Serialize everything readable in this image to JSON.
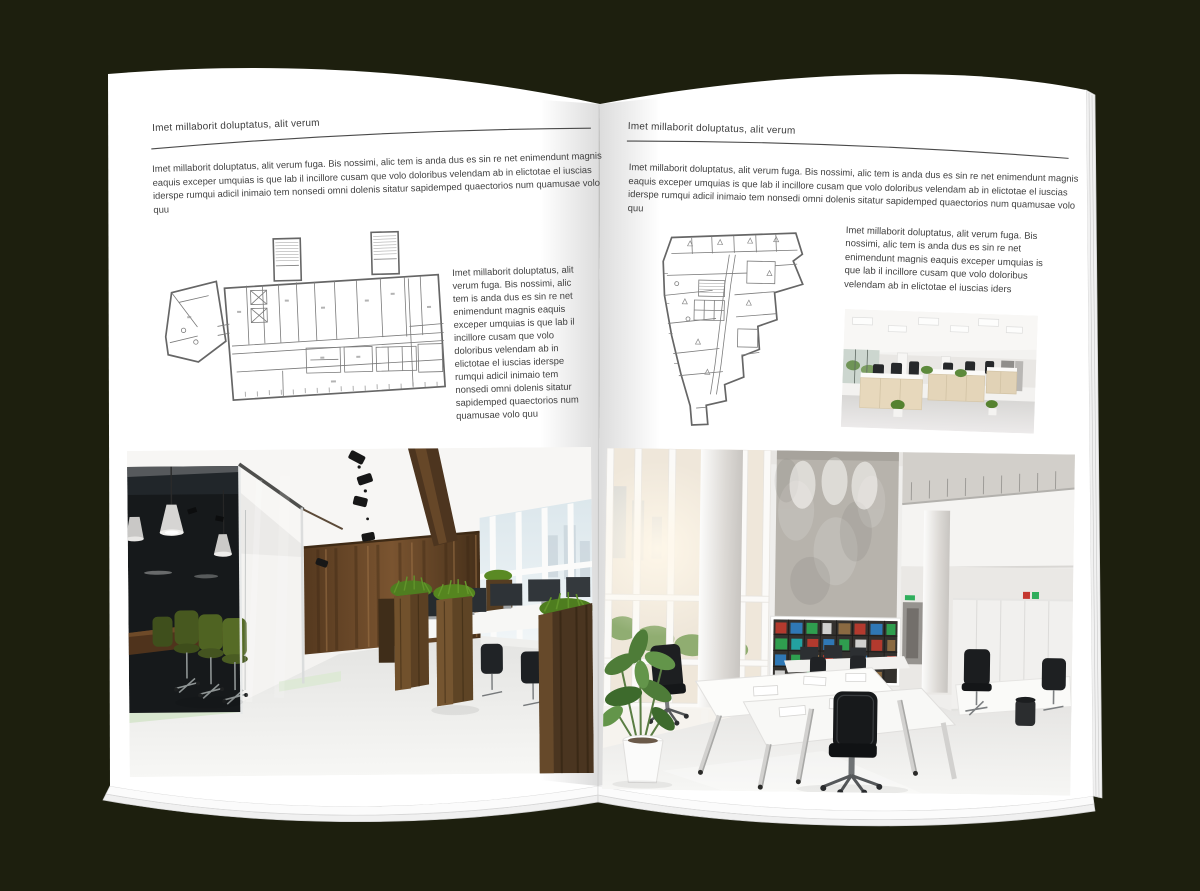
{
  "left_page": {
    "header": "Imet millaborit doluptatus, alit verum",
    "intro": "Imet millaborit doluptatus, alit verum fuga. Bis nossimi, alic tem is anda dus es sin re net enimendunt magnis eaquis exceper umquias is que lab il incillore cusam que volo doloribus velendam ab in elictotae el iuscias iderspe rumqui adicil inimaio tem nonsedi omni dolenis sitatur sapidemped quaectorios num quamusae volo quu",
    "column_text": "Imet millaborit doluptatus, alit verum fuga. Bis nossimi, alic tem is anda dus es sin re net enimendunt magnis eaquis exceper umquias is que lab il incillore cusam que volo doloribus velendam ab in elictotae el iuscias iderspe rumqui adicil inimaio tem nonsedi omni dolenis sitatur sapidemped quaectorios num quamusae volo quu"
  },
  "right_page": {
    "header": "Imet millaborit doluptatus, alit verum",
    "intro": "Imet millaborit doluptatus, alit verum fuga. Bis nossimi, alic tem is anda dus es sin re net enimendunt magnis eaquis exceper umquias is que lab il incillore cusam que volo doloribus velendam ab in elictotae el iuscias iderspe rumqui adicil inimaio tem nonsedi omni dolenis sitatur sapidemped quaectorios num quamusae volo quu",
    "block_text": "Imet millaborit doluptatus, alit verum fuga. Bis nossimi, alic tem is anda dus es sin re net enimendunt magnis eaquis exceper umquias is que lab il incillore cusam que volo doloribus velendam ab in elictotae el iuscias iders"
  },
  "colors": {
    "background": "#1d1f0e",
    "paper": "#ffffff",
    "text": "#424242",
    "rule": "#4a4a4a"
  },
  "images": {
    "left_floor_plan": "rectangular-office-floor-plan-drawing",
    "right_floor_plan": "irregular-office-floor-plan-drawing",
    "left_photo": "dark-wood-and-glass-office-interior-photo",
    "right_small_photo": "open-space-office-desks-photo",
    "right_photo": "bright-double-height-office-interior-photo"
  }
}
